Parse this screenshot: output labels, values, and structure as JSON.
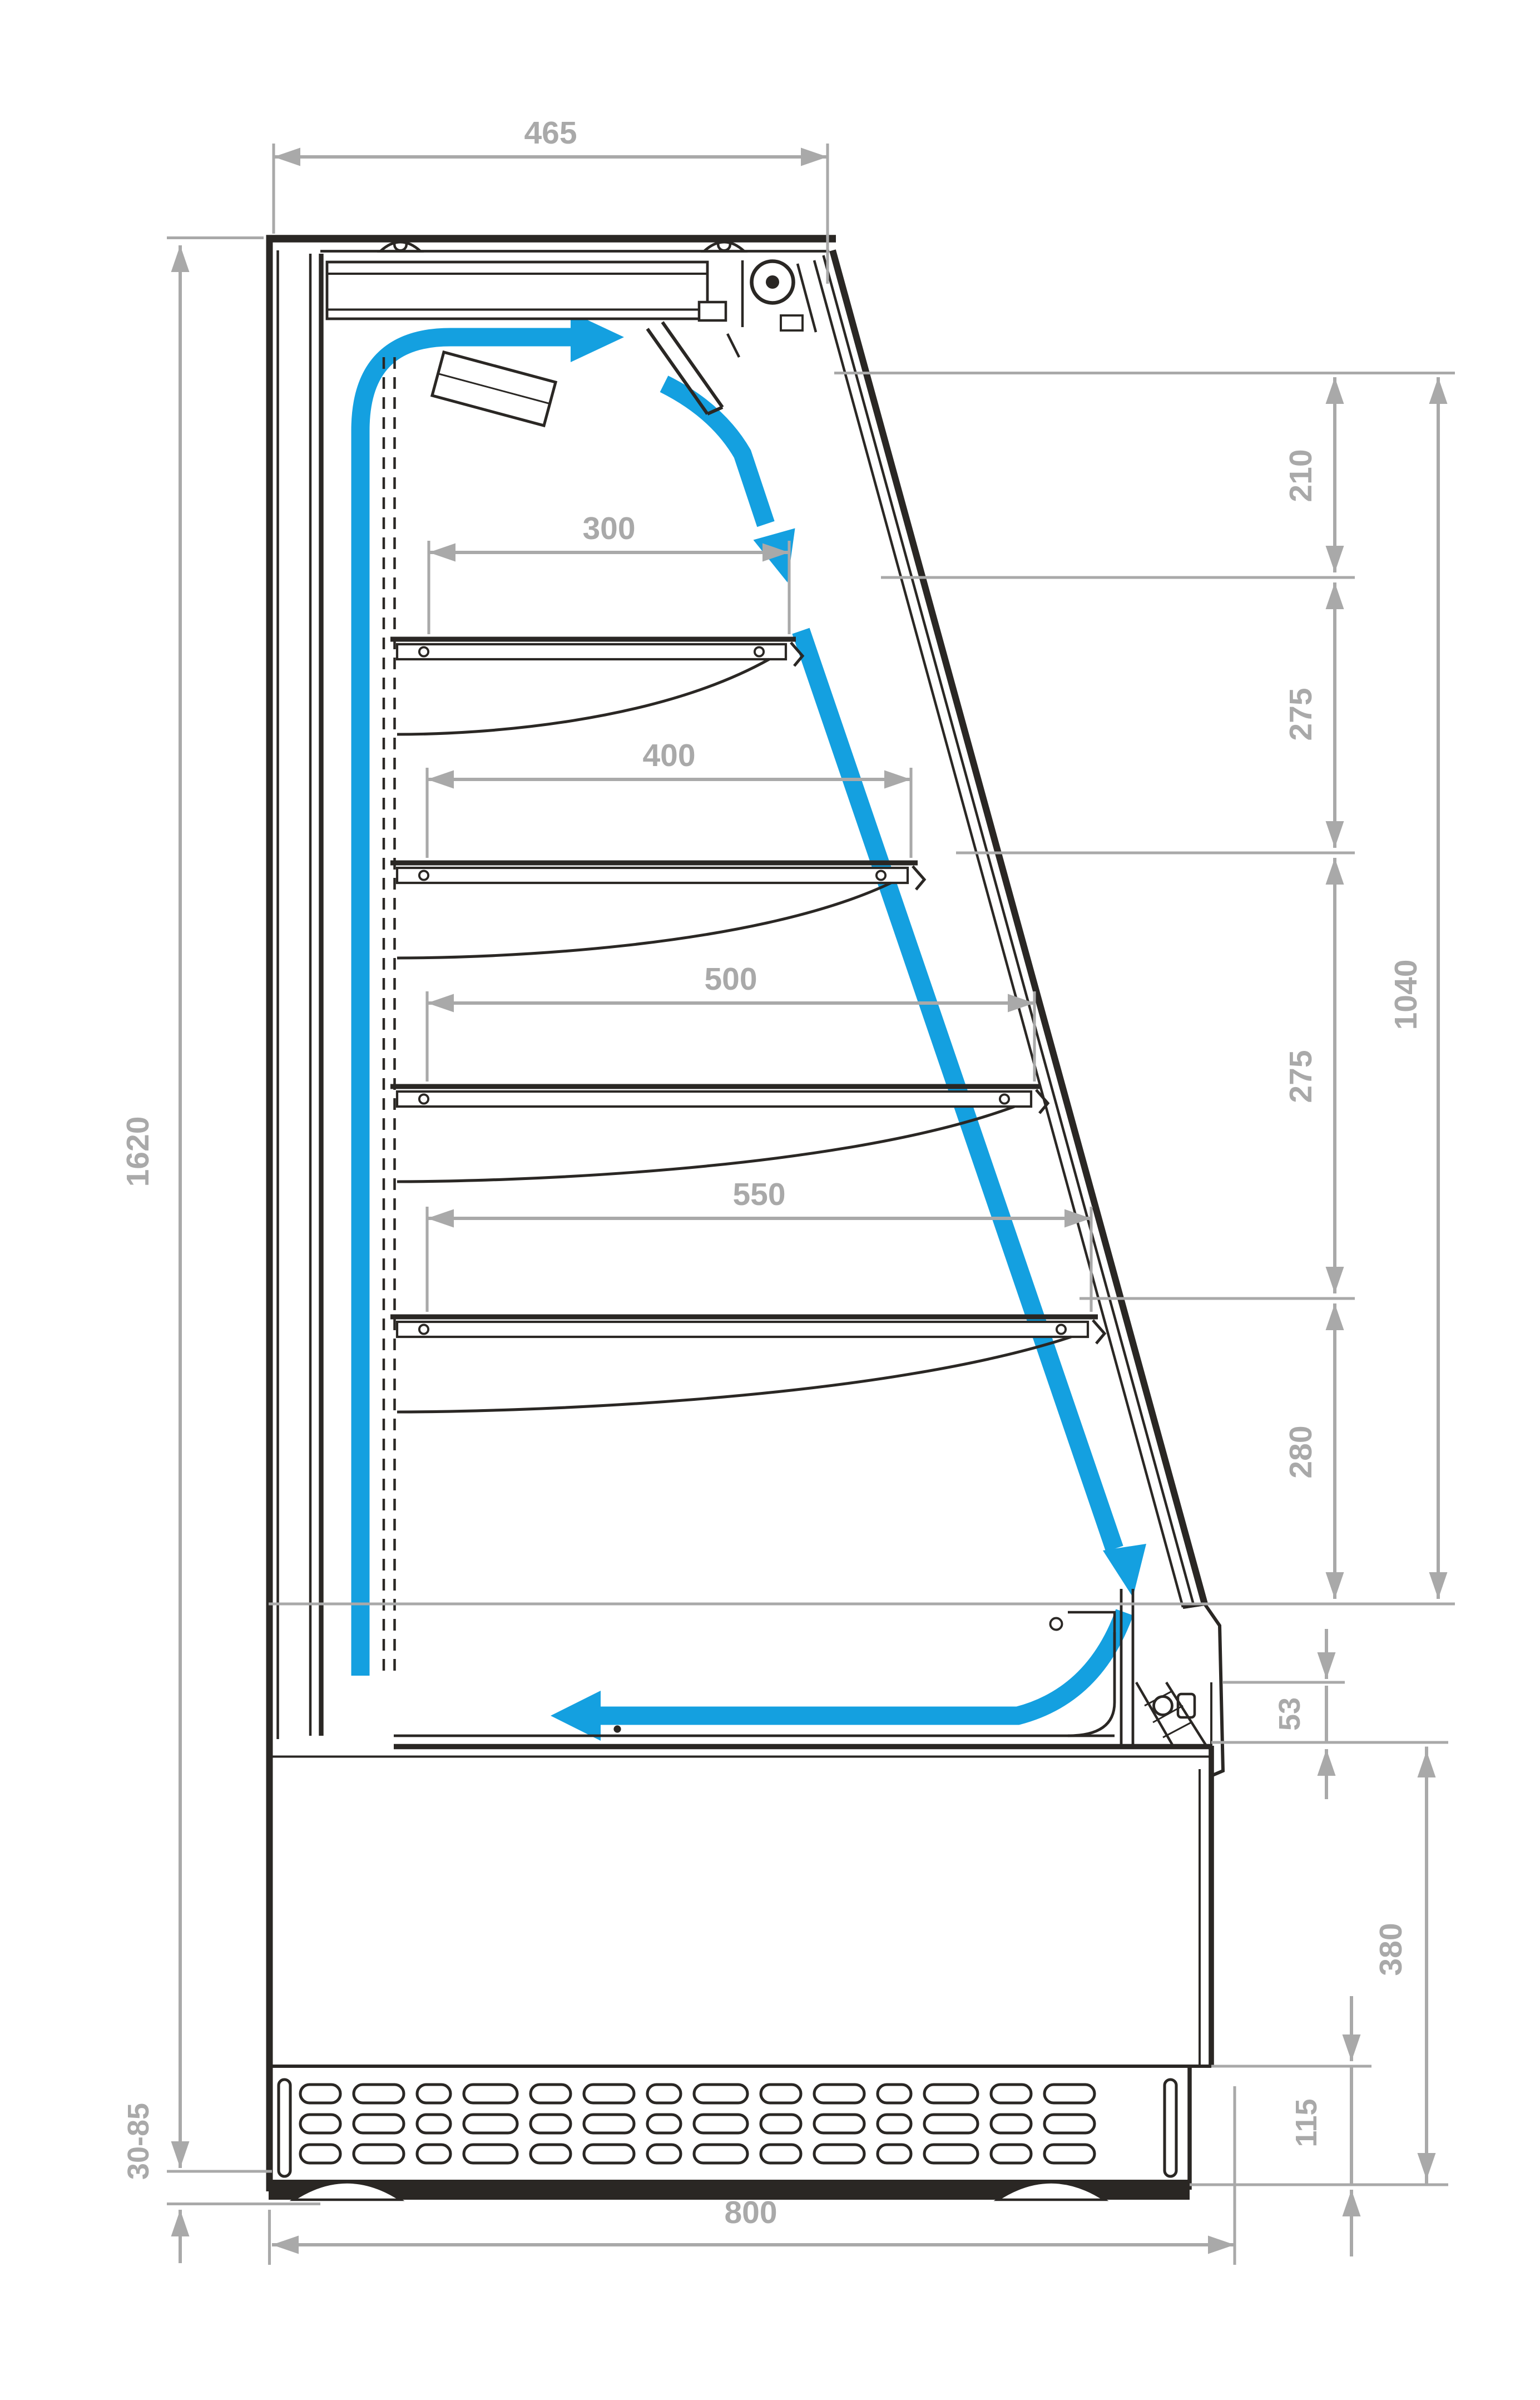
{
  "diagram": {
    "kind": "technical cross-section drawing",
    "subject": "open-front refrigerated display cabinet with air-circulation arrows",
    "units": "mm"
  },
  "colors": {
    "outline": "#2a2724",
    "dimension": "#a9a9a9",
    "airflow": "#14a0e0",
    "background": "#ffffff"
  },
  "icons": {
    "airflow": "blue curved arrows showing air loop (up rear duct, over canopy, down glass front, back along deck)",
    "fan": "fan/motor circle in top canopy",
    "vent": "slotted ventilation grille on base front"
  },
  "dims": {
    "top_depth": "465",
    "overall_height": "1620",
    "feet_range": "30-85",
    "overall_depth": "800",
    "shelf1": "300",
    "shelf2": "400",
    "shelf3": "500",
    "shelf4": "550",
    "seg_top": "210",
    "seg_mid1": "275",
    "seg_mid2": "275",
    "seg_low": "280",
    "glass_height": "1040",
    "bumper": "53",
    "base_height": "380",
    "grille_height": "115"
  }
}
